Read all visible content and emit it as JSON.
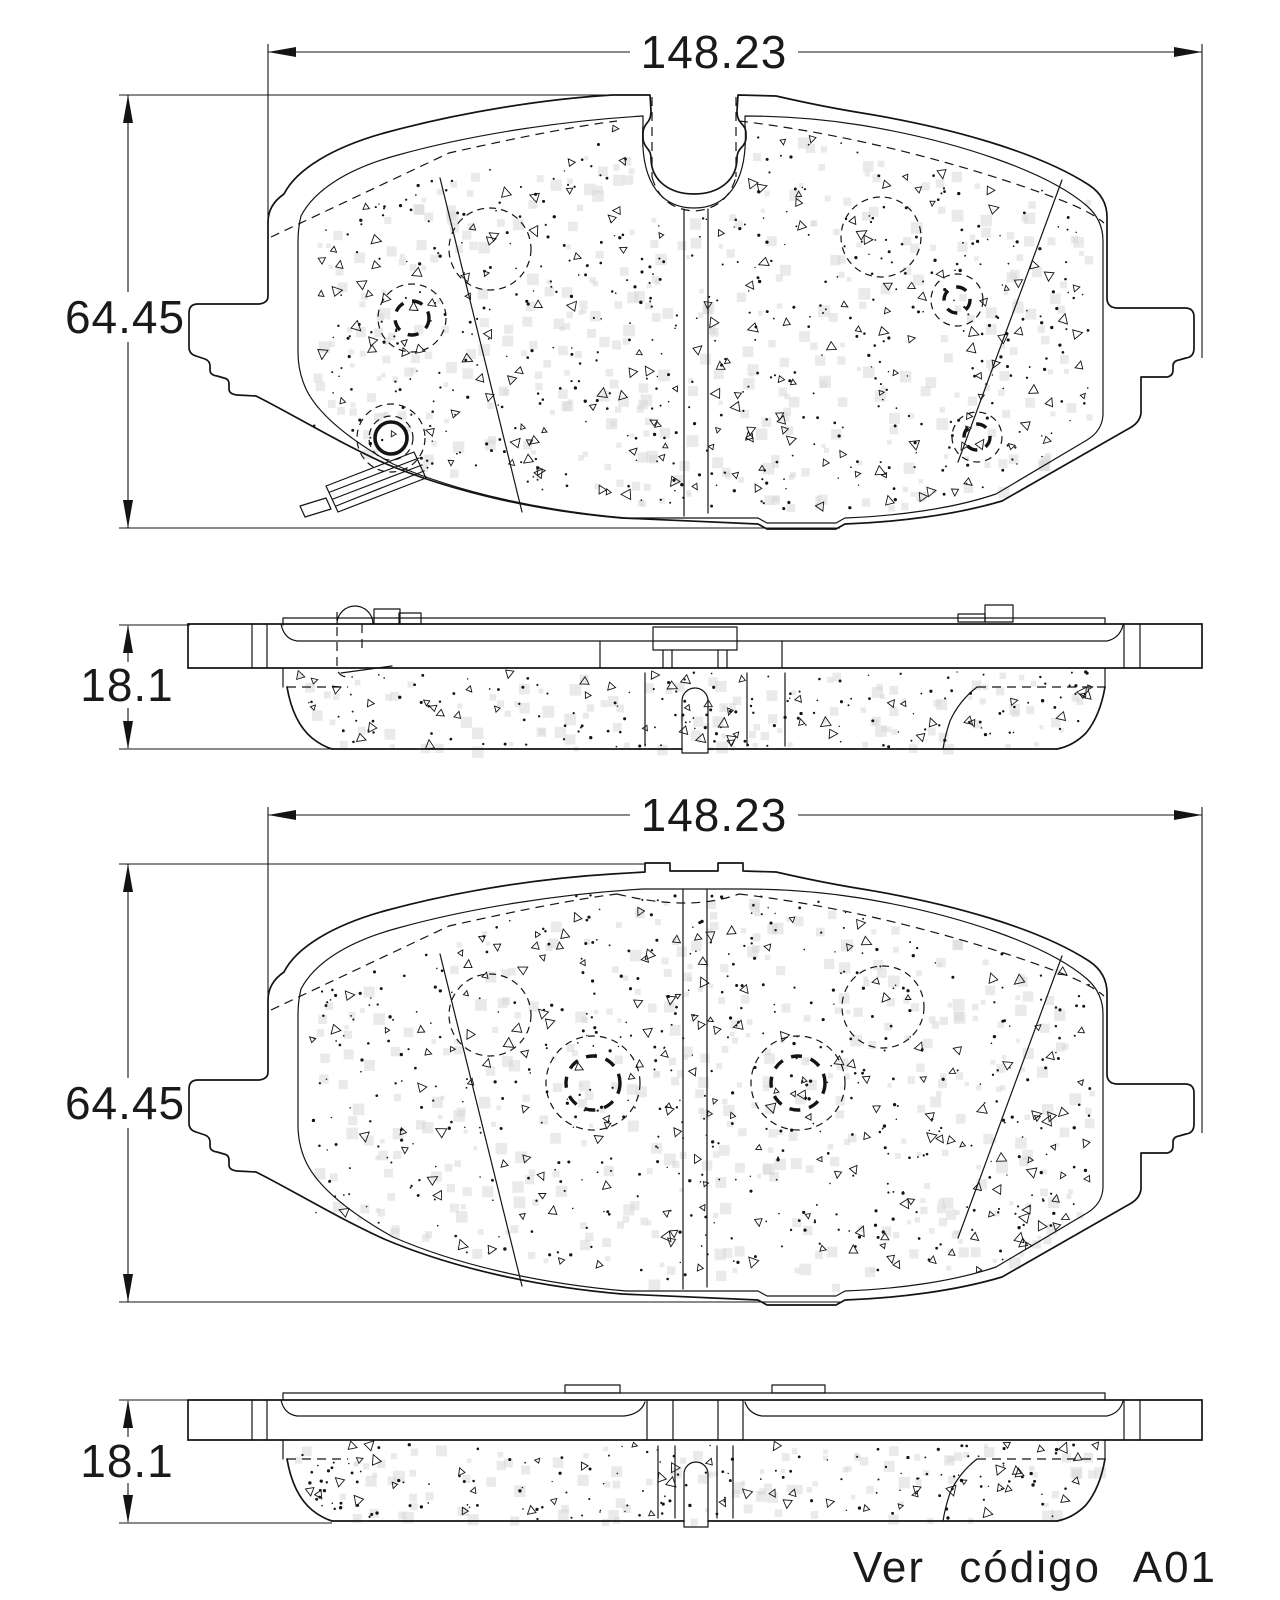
{
  "views": {
    "pad_front_1": {
      "width_label": "148.23",
      "height_label": "64.45"
    },
    "side_1": {
      "thickness_label": "18.1"
    },
    "pad_front_2": {
      "width_label": "148.23",
      "height_label": "64.45"
    },
    "side_2": {
      "thickness_label": "18.1"
    }
  },
  "footer": {
    "note": "Ver código A01"
  },
  "colors": {
    "line": "#141414",
    "noise": "#d6d6d6",
    "background": "#ffffff"
  }
}
